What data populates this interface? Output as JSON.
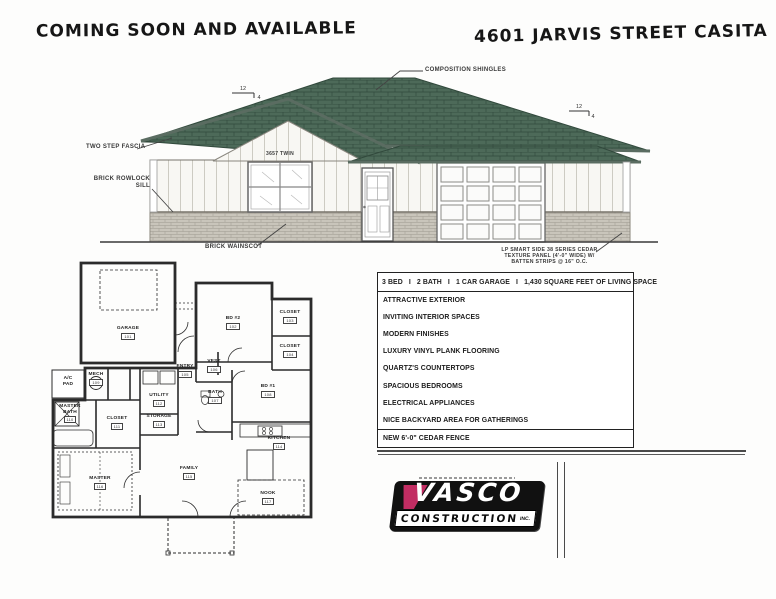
{
  "page": {
    "title_left": "COMING SOON AND AVAILABLE",
    "title_right": "4601 JARVIS STREET CASITA"
  },
  "elevation": {
    "labels": {
      "composition_shingles": "COMPOSITION SHINGLES",
      "two_step_fascia": "TWO STEP FASCIA",
      "brick_rowlock_line1": "BRICK ROWLOCK",
      "brick_rowlock_line2": "SILL",
      "brick_wainscot": "BRICK WAINSCOT",
      "siding_line1": "LP SMART SIDE 38 SERIES CEDAR",
      "siding_line2": "TEXTURE PANEL (4'-0\" WIDE) W/",
      "siding_line3": "BATTEN STRIPS @ 16\" O.C.",
      "window_label": "3657 TWIN",
      "slope_rise": "12",
      "slope_run": "4"
    }
  },
  "floor_plan": {
    "rooms": [
      {
        "name": "GARAGE",
        "number": "101"
      },
      {
        "name": "BD #2",
        "number": "102"
      },
      {
        "name": "CLOSET",
        "number": "103"
      },
      {
        "name": "CLOSET",
        "number": "104"
      },
      {
        "name": "ENTRY",
        "number": "105"
      },
      {
        "name": "VEST",
        "number": "106"
      },
      {
        "name": "BATH",
        "number": "107"
      },
      {
        "name": "BD #1",
        "number": "108"
      },
      {
        "name": "MECH",
        "number": "109"
      },
      {
        "name": "MASTER BATH",
        "number": "110"
      },
      {
        "name": "CLOSET",
        "number": "111"
      },
      {
        "name": "UTILITY",
        "number": "112"
      },
      {
        "name": "STORAGE",
        "number": "113"
      },
      {
        "name": "KITCHEN",
        "number": "114"
      },
      {
        "name": "FAMILY",
        "number": "115"
      },
      {
        "name": "MASTER",
        "number": "116"
      },
      {
        "name": "NOOK",
        "number": "117"
      },
      {
        "name": "A/C PAD",
        "number": ""
      }
    ]
  },
  "features": {
    "header": "3 BED   I   2 BATH   I   1 CAR GARAGE   I   1,430 SQUARE FEET OF LIVING SPACE",
    "items": [
      "ATTRACTIVE EXTERIOR",
      "INVITING INTERIOR SPACES",
      "MODERN FINISHES",
      "LUXURY VINYL PLANK FLOORING",
      "QUARTZ'S COUNTERTOPS",
      "SPACIOUS  BEDROOMS",
      "ELECTRICAL APPLIANCES",
      "NICE BACKYARD AREA FOR GATHERINGS",
      "NEW 6'-0\" CEDAR FENCE"
    ]
  },
  "logo": {
    "brand": "VASCO",
    "brand_sub": "CONSTRUCTION",
    "brand_suffix": "INC."
  },
  "colors": {
    "roof_green": "#4d6a59",
    "roof_line": "#31493c",
    "fascia": "#5a6c61",
    "brick": "#c9c5bb",
    "accent_magenta": "#c22d63",
    "ink": "#1d1d1d"
  }
}
